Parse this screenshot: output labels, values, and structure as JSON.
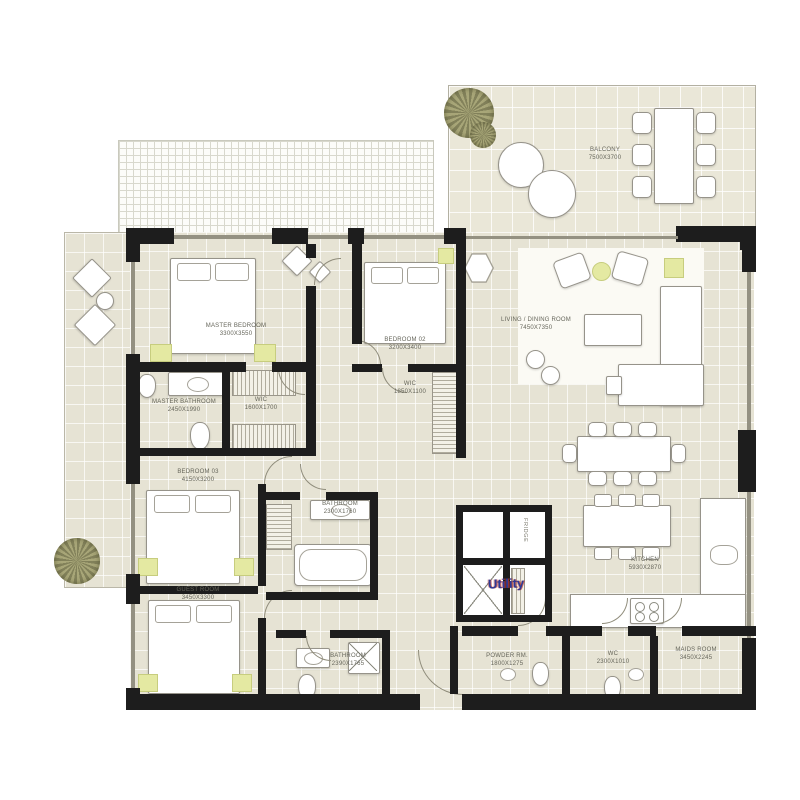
{
  "colors": {
    "wall": "#1d1d1d",
    "floor": "#e6e3d4",
    "accent_yellow": "#e4e9a2",
    "utility_text": "#2e3a96"
  },
  "rooms": {
    "balcony": {
      "label": "BALCONY",
      "dims": "7500X3700"
    },
    "master_bedroom": {
      "label": "MASTER BEDROOM",
      "dims": "3300X3550"
    },
    "bedroom_02": {
      "label": "BEDROOM 02",
      "dims": "3200X3400"
    },
    "living_dining": {
      "label": "LIVING / DINING ROOM",
      "dims": "7450X7350"
    },
    "master_bathroom": {
      "label": "MASTER BATHROOM",
      "dims": "2450X1990"
    },
    "wic_master": {
      "label": "WIC",
      "dims": "1600X1700"
    },
    "wic_bedroom02": {
      "label": "WIC",
      "dims": "1850X1100"
    },
    "bedroom_03": {
      "label": "BEDROOM 03",
      "dims": "4150X3200"
    },
    "bathroom_upper": {
      "label": "BATHROOM",
      "dims": "2300X1760"
    },
    "guest_room": {
      "label": "GUEST ROOM",
      "dims": "3450X3300"
    },
    "kitchen": {
      "label": "KITCHEN",
      "dims": "5930X2870"
    },
    "maids_room": {
      "label": "MAIDS ROOM",
      "dims": "3450X2245"
    },
    "powder_room": {
      "label": "POWDER RM.",
      "dims": "1800X1275"
    },
    "wc": {
      "label": "WC",
      "dims": "2300X1010"
    },
    "bathroom_lower": {
      "label": "BATHROOM",
      "dims": "2390X1765"
    }
  },
  "annotations": {
    "utility": "Utility",
    "fridge": "FRIDGE"
  }
}
